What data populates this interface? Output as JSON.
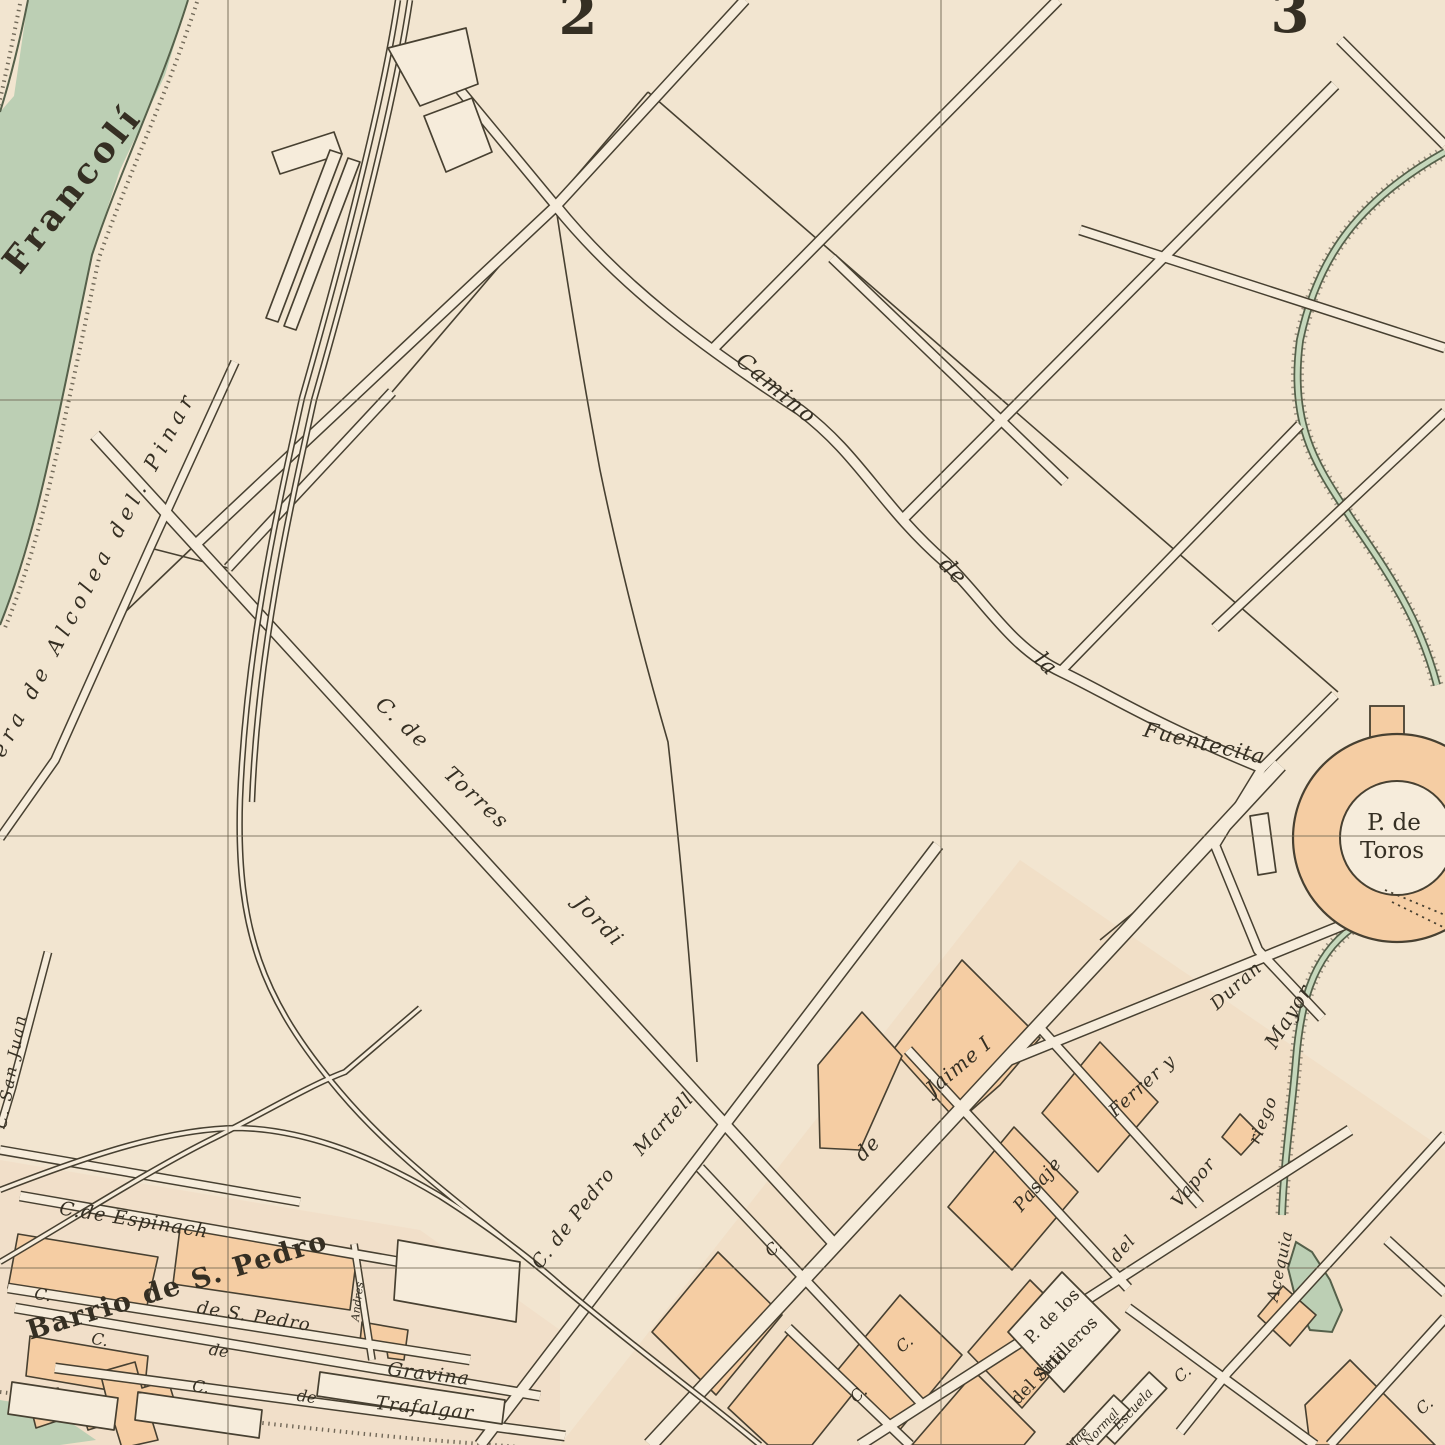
{
  "map": {
    "kind": "vintage-city-plan",
    "grid_numbers": [
      "2",
      "3"
    ],
    "colors": {
      "paper": "#f2e5d0",
      "ink": "#474031",
      "water": "#bccfb4",
      "built_block": "#f5cda3",
      "label_ink": "#352f23"
    },
    "water_features": {
      "river": "Francolí",
      "canal": "Acequia riego Mayor"
    },
    "landmarks": {
      "bullring": "P. de Toros",
      "plaza": "P. de los Artilleros del Sitio",
      "school": "Escuela Normal Mae",
      "district": "Barrio de S. Pedro"
    },
    "streets": [
      "era de Alcolea del. Pinar",
      "Camino de la Fuentecita",
      "C. de Torres Jordi",
      "C. de Pedro Martell",
      "de Jaime I",
      "Pasaje del Vapor",
      "Ferrer y Duran",
      "C. San Juan",
      "C.de Espinach",
      "de S. Pedro",
      "C. de Gravina",
      "C. de Trafalgar",
      "Andres"
    ]
  },
  "labels": [
    {
      "name": "river-francoli-label",
      "text": "Francolí",
      "x": 82,
      "y": 196,
      "rot": -52,
      "size": 35,
      "sp": 5,
      "cls": "big"
    },
    {
      "name": "grid-number-2",
      "text": "2",
      "x": 578,
      "y": 34,
      "rot": 0,
      "size": 56,
      "sp": 0,
      "cls": "num"
    },
    {
      "name": "grid-number-3",
      "text": "3",
      "x": 1290,
      "y": 32,
      "rot": 0,
      "size": 56,
      "sp": 0,
      "cls": "num"
    },
    {
      "name": "road-alcolea-label",
      "text": "era de Alcolea del. Pinar",
      "x": 100,
      "y": 577,
      "rot": -62,
      "size": 21,
      "sp": 6,
      "cls": "it"
    },
    {
      "name": "camino-label-word1",
      "text": "Camino",
      "x": 772,
      "y": 394,
      "rot": 40,
      "size": 22,
      "sp": 2,
      "cls": "it"
    },
    {
      "name": "camino-label-word2",
      "text": "de",
      "x": 948,
      "y": 576,
      "rot": 45,
      "size": 22,
      "sp": 1,
      "cls": "it"
    },
    {
      "name": "camino-label-word3",
      "text": "la",
      "x": 1041,
      "y": 669,
      "rot": 45,
      "size": 22,
      "sp": 1,
      "cls": "it"
    },
    {
      "name": "camino-label-word4",
      "text": "Fuentecita",
      "x": 1203,
      "y": 750,
      "rot": 13,
      "size": 21,
      "sp": 1,
      "cls": "it"
    },
    {
      "name": "torres-jordi-label-word1",
      "text": "C. de",
      "x": 398,
      "y": 728,
      "rot": 43,
      "size": 21,
      "sp": 2,
      "cls": "it"
    },
    {
      "name": "torres-jordi-label-word2",
      "text": "Torres",
      "x": 472,
      "y": 803,
      "rot": 43,
      "size": 21,
      "sp": 2,
      "cls": "it"
    },
    {
      "name": "torres-jordi-label-word3",
      "text": "Jordi",
      "x": 594,
      "y": 926,
      "rot": 46,
      "size": 21,
      "sp": 2,
      "cls": "it"
    },
    {
      "name": "plaza-toros-label-line1",
      "text": "P. de",
      "x": 1394,
      "y": 830,
      "rot": 0,
      "size": 23,
      "sp": 0,
      "cls": ""
    },
    {
      "name": "plaza-toros-label-line2",
      "text": "Toros",
      "x": 1392,
      "y": 858,
      "rot": 0,
      "size": 23,
      "sp": 0,
      "cls": ""
    },
    {
      "name": "pedro-martell-label-word1",
      "text": "C. de Pedro",
      "x": 578,
      "y": 1222,
      "rot": -52,
      "size": 19,
      "sp": 1,
      "cls": "it"
    },
    {
      "name": "pedro-martell-label-word2",
      "text": "Martell",
      "x": 668,
      "y": 1128,
      "rot": -47,
      "size": 19,
      "sp": 1,
      "cls": "it"
    },
    {
      "name": "jaime-label-word1",
      "text": "de",
      "x": 872,
      "y": 1153,
      "rot": -45,
      "size": 20,
      "sp": 1,
      "cls": "it"
    },
    {
      "name": "jaime-label-word2",
      "text": "Jaime I",
      "x": 963,
      "y": 1071,
      "rot": -40,
      "size": 20,
      "sp": 1,
      "cls": "it"
    },
    {
      "name": "pasaje-label",
      "text": "Pasaje",
      "x": 1042,
      "y": 1188,
      "rot": -50,
      "size": 18,
      "sp": 1,
      "cls": "it"
    },
    {
      "name": "del-label",
      "text": "del",
      "x": 1127,
      "y": 1252,
      "rot": -50,
      "size": 17,
      "sp": 1,
      "cls": "it"
    },
    {
      "name": "vapor-label",
      "text": "Vapor",
      "x": 1198,
      "y": 1186,
      "rot": -50,
      "size": 18,
      "sp": 1,
      "cls": "it"
    },
    {
      "name": "ferrer-duran-label-word1",
      "text": "Ferrer y",
      "x": 1146,
      "y": 1090,
      "rot": -42,
      "size": 18,
      "sp": 1,
      "cls": "it"
    },
    {
      "name": "ferrer-duran-label-word2",
      "text": "Duran",
      "x": 1240,
      "y": 990,
      "rot": -42,
      "size": 18,
      "sp": 1,
      "cls": "it"
    },
    {
      "name": "acequia-label-word1",
      "text": "Acequia",
      "x": 1285,
      "y": 1267,
      "rot": -78,
      "size": 16,
      "sp": 1,
      "cls": "it"
    },
    {
      "name": "acequia-label-word2",
      "text": "riego",
      "x": 1268,
      "y": 1122,
      "rot": -68,
      "size": 17,
      "sp": 1,
      "cls": "it"
    },
    {
      "name": "acequia-label-word3",
      "text": "Mayor",
      "x": 1294,
      "y": 1020,
      "rot": -58,
      "size": 20,
      "sp": 1,
      "cls": "it"
    },
    {
      "name": "artilleros-label-line1",
      "text": "P. de los",
      "x": 1056,
      "y": 1320,
      "rot": -45,
      "size": 17,
      "sp": 0,
      "cls": ""
    },
    {
      "name": "artilleros-label-line2",
      "text": "Artilleros",
      "x": 1070,
      "y": 1352,
      "rot": -45,
      "size": 17,
      "sp": 0,
      "cls": ""
    },
    {
      "name": "artilleros-label-line3",
      "text": "del Sitio",
      "x": 1043,
      "y": 1380,
      "rot": -45,
      "size": 17,
      "sp": 0,
      "cls": ""
    },
    {
      "name": "escuela-label-line1",
      "text": "Escuela",
      "x": 1136,
      "y": 1412,
      "rot": -47,
      "size": 13,
      "sp": 0,
      "cls": "it"
    },
    {
      "name": "escuela-label-line2",
      "text": "Normal",
      "x": 1104,
      "y": 1430,
      "rot": -47,
      "size": 12,
      "sp": 0,
      "cls": "it"
    },
    {
      "name": "escuela-label-line3",
      "text": "Mae",
      "x": 1080,
      "y": 1442,
      "rot": -47,
      "size": 12,
      "sp": 0,
      "cls": "it"
    },
    {
      "name": "san-juan-label",
      "text": "C. San Juan",
      "x": 16,
      "y": 1072,
      "rot": -80,
      "size": 16,
      "sp": 2,
      "cls": "it"
    },
    {
      "name": "espinach-label",
      "text": "C.de Espinach",
      "x": 133,
      "y": 1226,
      "rot": 9,
      "size": 19,
      "sp": 1,
      "cls": "it"
    },
    {
      "name": "barrio-label",
      "text": "Barrio de S. Pedro",
      "x": 180,
      "y": 1294,
      "rot": -17,
      "size": 27,
      "sp": 2,
      "cls": "big"
    },
    {
      "name": "san-pedro-street-label",
      "text": "de S. Pedro",
      "x": 253,
      "y": 1322,
      "rot": 9,
      "size": 18,
      "sp": 1,
      "cls": "it"
    },
    {
      "name": "street-c-label-1",
      "text": "C.",
      "x": 42,
      "y": 1300,
      "rot": 9,
      "size": 16,
      "sp": 0,
      "cls": "it"
    },
    {
      "name": "street-c-label-2",
      "text": "C.",
      "x": 99,
      "y": 1345,
      "rot": 9,
      "size": 16,
      "sp": 0,
      "cls": "it"
    },
    {
      "name": "gravina-label-de",
      "text": "de",
      "x": 218,
      "y": 1356,
      "rot": 9,
      "size": 16,
      "sp": 0,
      "cls": "it"
    },
    {
      "name": "gravina-label",
      "text": "Gravina",
      "x": 428,
      "y": 1380,
      "rot": 7,
      "size": 19,
      "sp": 1,
      "cls": "it"
    },
    {
      "name": "street-c-label-3",
      "text": "C.",
      "x": 200,
      "y": 1392,
      "rot": 8,
      "size": 16,
      "sp": 0,
      "cls": "it"
    },
    {
      "name": "trafalgar-label-de",
      "text": "de",
      "x": 306,
      "y": 1402,
      "rot": 8,
      "size": 16,
      "sp": 0,
      "cls": "it"
    },
    {
      "name": "trafalgar-label",
      "text": "Trafalgar",
      "x": 424,
      "y": 1414,
      "rot": 6,
      "size": 19,
      "sp": 1,
      "cls": "it"
    },
    {
      "name": "andres-label",
      "text": "Andres",
      "x": 361,
      "y": 1302,
      "rot": -83,
      "size": 11,
      "sp": 0,
      "cls": "it"
    },
    {
      "name": "street-c-label-4",
      "text": "C.",
      "x": 777,
      "y": 1252,
      "rot": -40,
      "size": 16,
      "sp": 0,
      "cls": "it"
    },
    {
      "name": "street-c-label-5",
      "text": "C.",
      "x": 908,
      "y": 1348,
      "rot": -40,
      "size": 16,
      "sp": 0,
      "cls": "it"
    },
    {
      "name": "street-c-label-6",
      "text": "C.",
      "x": 862,
      "y": 1398,
      "rot": -40,
      "size": 16,
      "sp": 0,
      "cls": "it"
    },
    {
      "name": "street-c-label-7",
      "text": "C.",
      "x": 1186,
      "y": 1378,
      "rot": -40,
      "size": 16,
      "sp": 0,
      "cls": "it"
    },
    {
      "name": "street-c-label-8",
      "text": "C.",
      "x": 1428,
      "y": 1410,
      "rot": -40,
      "size": 16,
      "sp": 0,
      "cls": "it"
    }
  ]
}
